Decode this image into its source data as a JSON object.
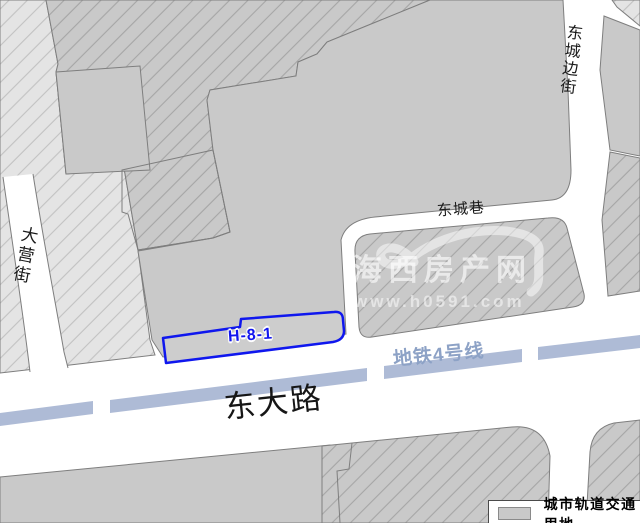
{
  "map_labels": {
    "main_road": "东大路",
    "left_street": "大营街",
    "right_street": "东城边街",
    "lane": "东城巷",
    "metro_line": "地铁4号线",
    "parcel_id": "H-8-1"
  },
  "legend": {
    "rail_transit_label": "城市轨道交通用地"
  },
  "watermark": {
    "site_name": "海西房产网",
    "site_url": "www.h0591.com"
  },
  "colors": {
    "metro_band": "#aebbd6",
    "metro_label": "#8da2c6",
    "parcel_outline": "#0f17ee",
    "parcel_label": "#1216ee",
    "parcel_fill": "#cdcdcd",
    "block_gray": "#c9c9c9",
    "block_light": "#e4e4e4",
    "road_white": "#ffffff",
    "label_dark": "#1a1a1a"
  }
}
